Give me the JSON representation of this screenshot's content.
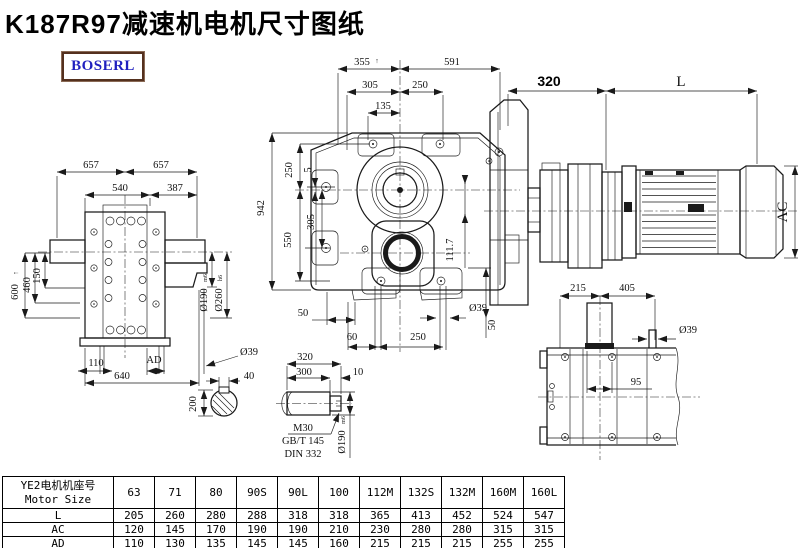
{
  "title": "K187R97减速机电机尺寸图纸",
  "logo": "BOSERL",
  "left_view": {
    "d657a": "657",
    "d657b": "657",
    "d540": "540",
    "d387": "387",
    "d600": "600",
    "d600_mark": "↑",
    "d460": "460",
    "d150": "150",
    "d110": "110",
    "dad": "AD",
    "d640": "640",
    "dia39": "Ø39",
    "dia190": "Ø190",
    "dia190_fit": "m6",
    "dia260": "Ø260",
    "dia260_fit": "h6"
  },
  "front_view": {
    "d355": "355",
    "d355_mark": "↑",
    "d591": "591",
    "d305_top": "305",
    "d250_top": "250",
    "d135": "135",
    "d942": "942",
    "d250_left": "250",
    "d5": "5",
    "d305_left": "305",
    "d550": "550",
    "d50_left": "50",
    "d60": "60",
    "d250_bottom": "250",
    "dia39": "Ø39",
    "d50_right": "50",
    "d111_7": "111.7"
  },
  "side_view": {
    "d320": "320",
    "dl": "L",
    "dac": "AC",
    "d215": "215",
    "d405": "405"
  },
  "top_view": {
    "dia39": "Ø39",
    "d95": "95"
  },
  "shaft_detail": {
    "d40": "40",
    "d200": "200",
    "d320": "320",
    "d300": "300",
    "d10": "10",
    "thread": "M30",
    "std1": "GB/T 145",
    "std2": "DIN 332",
    "dia190": "Ø190",
    "dia190_fit": "m6"
  },
  "table": {
    "header_cn": "YE2电机机座号",
    "header_en": "Motor Size",
    "columns": [
      "63",
      "71",
      "80",
      "90S",
      "90L",
      "100",
      "112M",
      "132S",
      "132M",
      "160M",
      "160L"
    ],
    "rows": [
      {
        "label": "L",
        "values": [
          "205",
          "260",
          "280",
          "288",
          "318",
          "318",
          "365",
          "413",
          "452",
          "524",
          "547"
        ]
      },
      {
        "label": "AC",
        "values": [
          "120",
          "145",
          "170",
          "190",
          "190",
          "210",
          "230",
          "280",
          "280",
          "315",
          "315"
        ]
      },
      {
        "label": "AD",
        "values": [
          "110",
          "130",
          "135",
          "145",
          "145",
          "160",
          "215",
          "215",
          "215",
          "255",
          "255"
        ]
      }
    ]
  }
}
